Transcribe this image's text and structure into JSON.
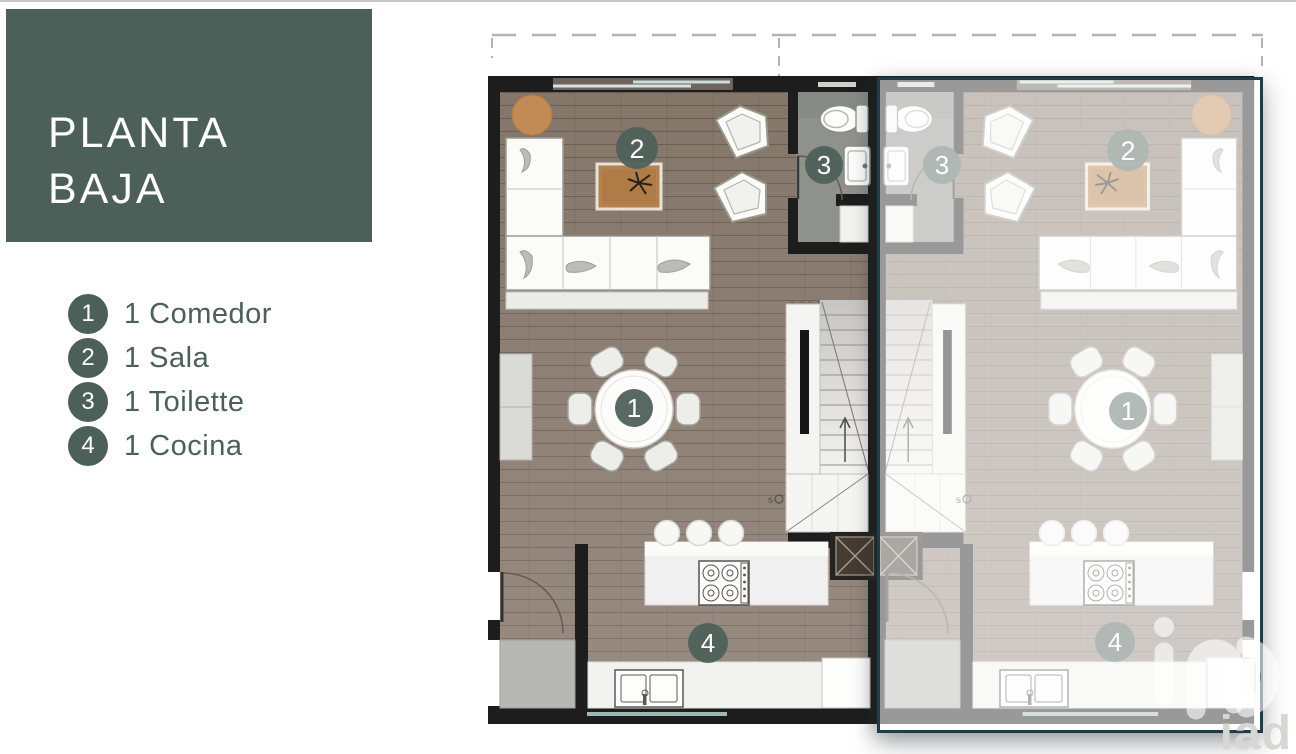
{
  "title_card": {
    "line1": "PLANTA",
    "line2": "BAJA",
    "bg_color": "#4c5f58",
    "text_color": "#ffffff"
  },
  "legend": {
    "text_color": "#4c5f58",
    "badge_color": "#4c5f58",
    "items": [
      {
        "badge": "1",
        "label": "1 Comedor"
      },
      {
        "badge": "2",
        "label": "1 Sala"
      },
      {
        "badge": "3",
        "label": "1 Toilette"
      },
      {
        "badge": "4",
        "label": "1 Cocina"
      }
    ]
  },
  "floor_plan": {
    "units": [
      {
        "name": "left-unit",
        "faded": false
      },
      {
        "name": "right-unit",
        "faded": true
      }
    ],
    "markers": {
      "comedor": "1",
      "sala": "2",
      "toilette": "3",
      "cocina": "4"
    },
    "stair_note": "s",
    "colors": {
      "wall": "#1d1d1d",
      "wood_floor": "#85766a",
      "tile_floor": "#8e918c",
      "marker": "#4e615a",
      "window_glass": "#cfe3e2",
      "selection_border": "#1f3c49"
    }
  },
  "watermark": {
    "logo_text": "iad"
  }
}
